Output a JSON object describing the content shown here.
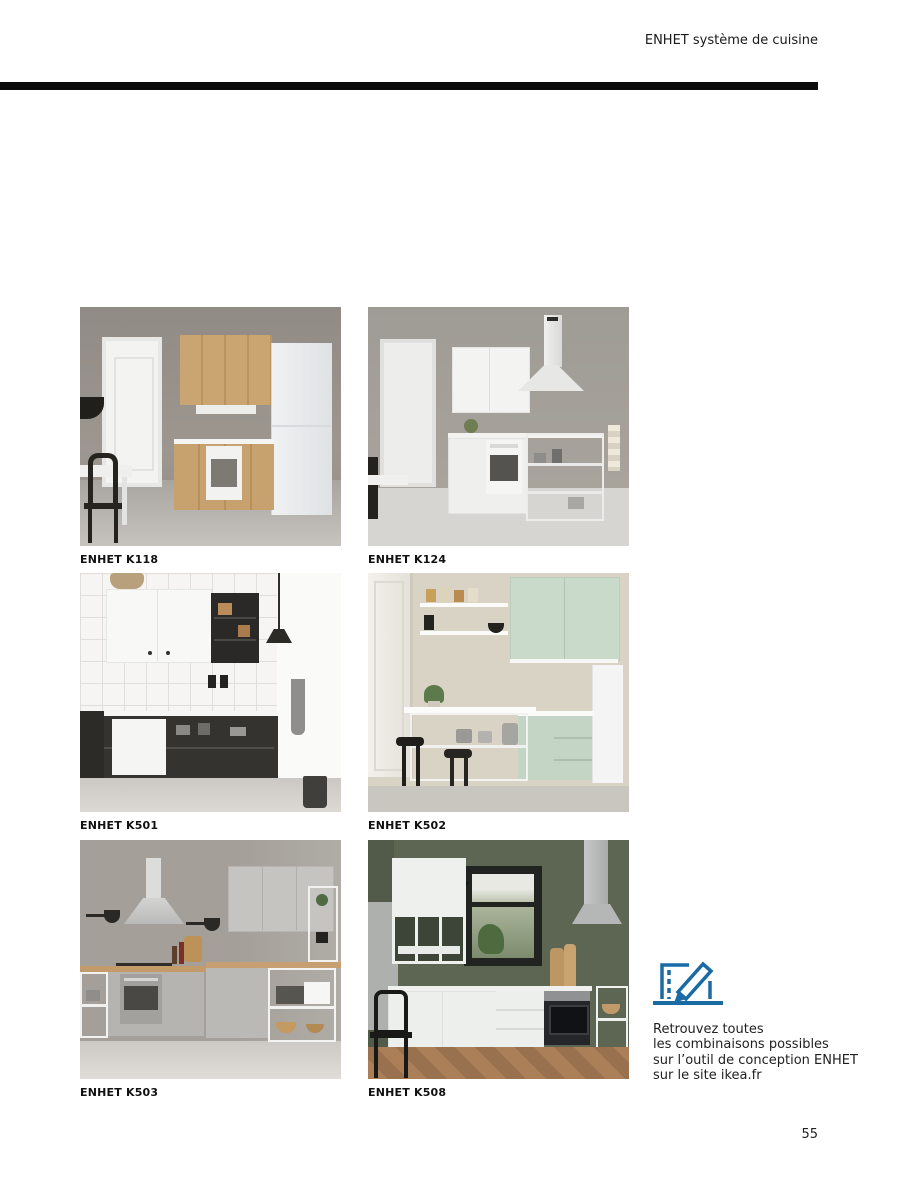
{
  "page": {
    "header": "ENHET système de cuisine",
    "page_number": "55"
  },
  "colors": {
    "accent_blue": "#1a6aa3",
    "divider_black": "#0b0b0b"
  },
  "gallery": {
    "items": [
      {
        "label": "ENHET K118"
      },
      {
        "label": "ENHET K124"
      },
      {
        "label": "ENHET K501"
      },
      {
        "label": "ENHET K502"
      },
      {
        "label": "ENHET K503"
      },
      {
        "label": "ENHET K508"
      }
    ]
  },
  "info": {
    "icon": "design-tool-icon",
    "lines": [
      "Retrouvez toutes",
      "les combinaisons possibles",
      "sur l’outil de conception ENHET",
      "sur le site ikea.fr"
    ]
  }
}
